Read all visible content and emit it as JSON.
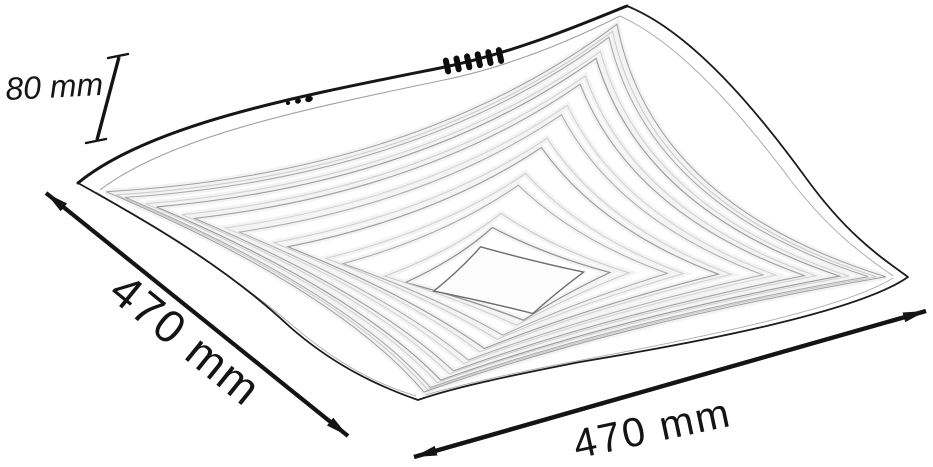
{
  "diagram": {
    "title": "Ceiling lamp dimension drawing",
    "labels": {
      "height": "80 mm",
      "depth": "470 mm",
      "width": "470 mm"
    },
    "colors": {
      "dimension_line": "#141414",
      "lamp_outline": "#1c1c1c",
      "lamp_panel_line": "#ababab",
      "background": "#ffffff"
    },
    "features": {
      "connector_pins": 6,
      "mount_dots": 3
    }
  }
}
